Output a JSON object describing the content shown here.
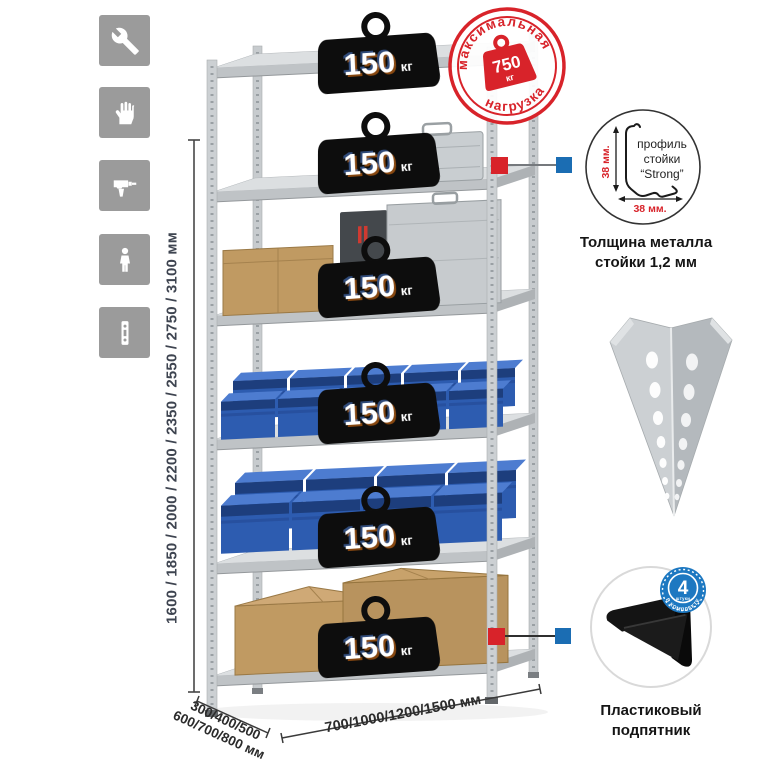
{
  "sidebar": {
    "icons": [
      {
        "name": "wrench"
      },
      {
        "name": "gloves"
      },
      {
        "name": "drill"
      },
      {
        "name": "person"
      },
      {
        "name": "rack-post"
      }
    ]
  },
  "height_dim": {
    "label": "1600 / 1850 / 2000 / 2200 / 2350 / 2550 / 2750 / 3100 мм"
  },
  "depth_dim": {
    "line1": "300/400/500",
    "line2": "600/700/800 мм"
  },
  "width_dim": {
    "label": "700/1000/1200/1500 мм"
  },
  "stamp": {
    "arc_top": "максимальная",
    "arc_bottom": "нагрузка",
    "value": "750",
    "unit": "кг"
  },
  "shelves": [
    {
      "load": "150",
      "unit": "кг"
    },
    {
      "load": "150",
      "unit": "кг"
    },
    {
      "load": "150",
      "unit": "кг"
    },
    {
      "load": "150",
      "unit": "кг"
    },
    {
      "load": "150",
      "unit": "кг"
    },
    {
      "load": "150",
      "unit": "кг"
    }
  ],
  "profile": {
    "line1": "профиль",
    "line2": "стойки",
    "line3": "“Strong”",
    "dim_v": "38 мм.",
    "dim_h": "38 мм.",
    "caption1": "Толщина металла",
    "caption2": "стойки 1,2 мм"
  },
  "foot": {
    "badge_value": "4",
    "badge_sub": "штуки",
    "badge_arc": "в комплекте",
    "caption1": "Пластиковый",
    "caption2": "подпятник"
  },
  "colors": {
    "accent_red": "#d8232a",
    "accent_blue": "#1b6db3",
    "bin_blue": "#2d5cb0",
    "metal_gray": "#ccd0d3",
    "cardboard": "#c09a62",
    "icon_gray": "#9b9b9b"
  }
}
